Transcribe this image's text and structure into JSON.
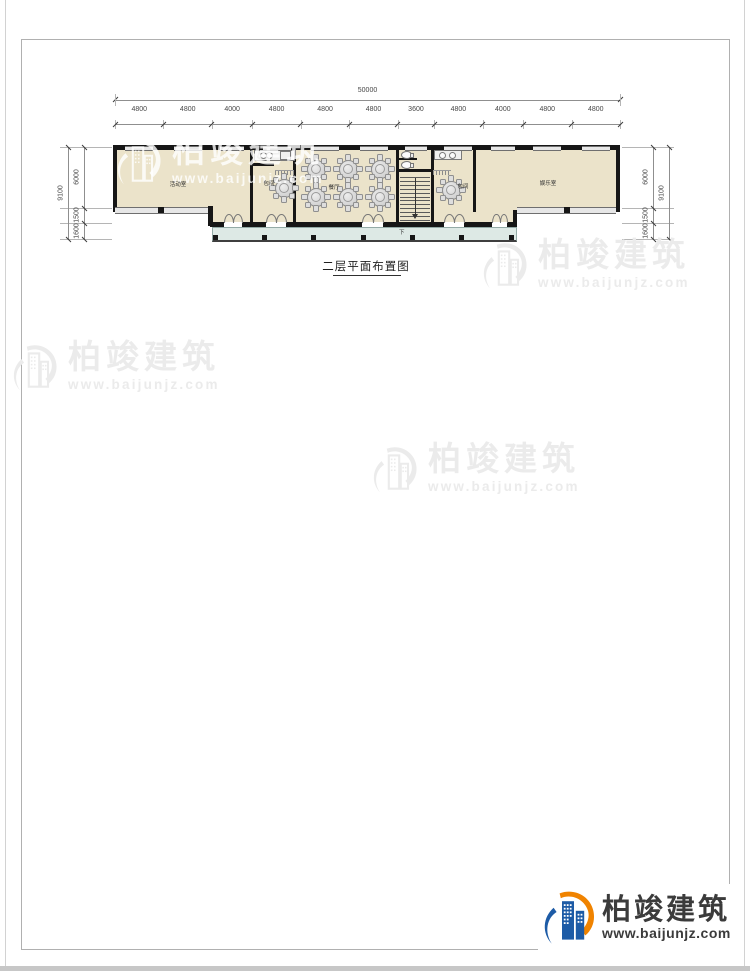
{
  "plan": {
    "caption": "二层平面布置图",
    "stair_label": "下",
    "rooms": [
      {
        "label": "活动室",
        "x": 178,
        "y": 184
      },
      {
        "label": "包间",
        "x": 269,
        "y": 183
      },
      {
        "label": "餐厅",
        "x": 334,
        "y": 187
      },
      {
        "label": "包间",
        "x": 463,
        "y": 186
      },
      {
        "label": "娱乐室",
        "x": 548,
        "y": 183
      }
    ]
  },
  "dimensions": {
    "top": {
      "total": "50000",
      "bays": [
        "4800",
        "4800",
        "4000",
        "4800",
        "4800",
        "4800",
        "3600",
        "4800",
        "4000",
        "4800",
        "4800"
      ]
    },
    "left": {
      "total": "9100",
      "segments": [
        "6000",
        "1500",
        "1600"
      ]
    },
    "right": {
      "total": "9100",
      "segments": [
        "6000",
        "1500",
        "1600"
      ]
    }
  },
  "watermark": {
    "brand": "柏竣建筑",
    "url": "www.baijunjz.com"
  },
  "logo": {
    "brand": "柏竣建筑",
    "url": "www.baijunjz.com"
  },
  "colors": {
    "room_fill": "#ebe3ca",
    "porch_fill": "#dde9e5",
    "wall": "#161616",
    "logo_orange": "#f08300",
    "logo_blue": "#1d5ba6",
    "logo_text": "#3b3b3b"
  }
}
